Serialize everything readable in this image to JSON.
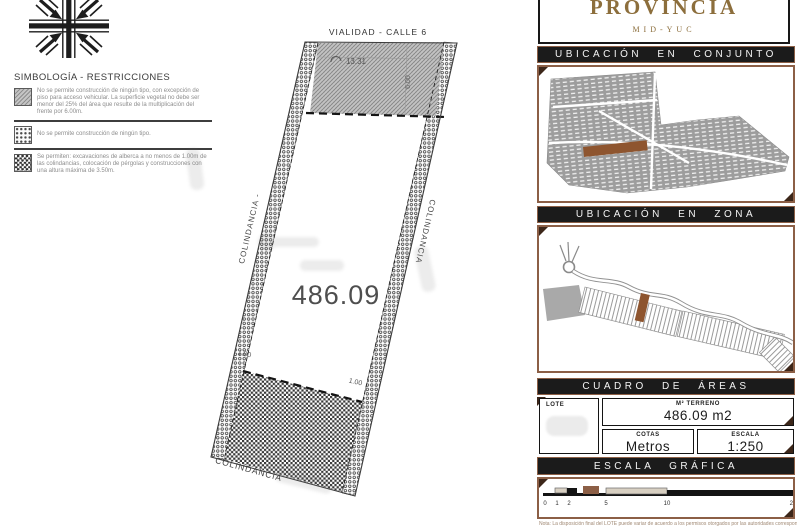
{
  "legend": {
    "title": "SIMBOLOGÍA - RESTRICCIONES",
    "items": [
      {
        "swatch": "diagonal-hatch",
        "text": "No se permite construcción de ningún tipo, con excepción de piso para acceso vehicular. La superficie vegetal no debe ser menor del 25% del área que resulte de la multiplicación del frente por 6.00m."
      },
      {
        "swatch": "dot-hatch",
        "text": "No se permite construcción de ningún tipo."
      },
      {
        "swatch": "checker-hatch",
        "text": "Se permiten: excavaciones de alberca a no menos de 1.00m de las colindancias, colocación de pérgolas y construcciones con una altura máxima de 3.50m."
      }
    ]
  },
  "plot": {
    "street_label": "VIALIDAD - CALLE 6",
    "front_dimension": "13.31",
    "setback_dimension": "6.00",
    "area": "486.09",
    "left_boundary_label": "COLINDANCIA -",
    "right_boundary_label": "COLINDANCIA",
    "bottom_boundary_label": "COLINDANCIA",
    "offset_left": "1.00",
    "offset_right": "1.00"
  },
  "brand": {
    "name": "PROVINCIA",
    "sub": "MID-YUC"
  },
  "sections": {
    "conjunto_title": "UBICACIÓN EN CONJUNTO",
    "zona_title": "UBICACIÓN EN ZONA",
    "areas_title": "CUADRO DE ÁREAS",
    "escala_title": "ESCALA GRÁFICA"
  },
  "areas_table": {
    "lote_header": "LOTE",
    "terreno_header": "M² TERRENO",
    "terreno_value": "486.09 m2",
    "cotas_header": "COTAS",
    "cotas_value": "Metros",
    "escala_header": "ESCALA",
    "escala_value": "1:250"
  },
  "scale_bar": {
    "ticks": [
      "0",
      "1",
      "2",
      "5",
      "10",
      "20"
    ]
  },
  "note": "Nota: La disposición final del LOTE puede variar de acuerdo a los permisos otorgados por las autoridades correspondientes.",
  "colors": {
    "frame_brown": "#8c5f46",
    "corner_dark": "#3c2619",
    "bar_black": "#1b1b1b",
    "brand_gold": "#8c6e3c",
    "highlight_brown": "#8e552f"
  }
}
